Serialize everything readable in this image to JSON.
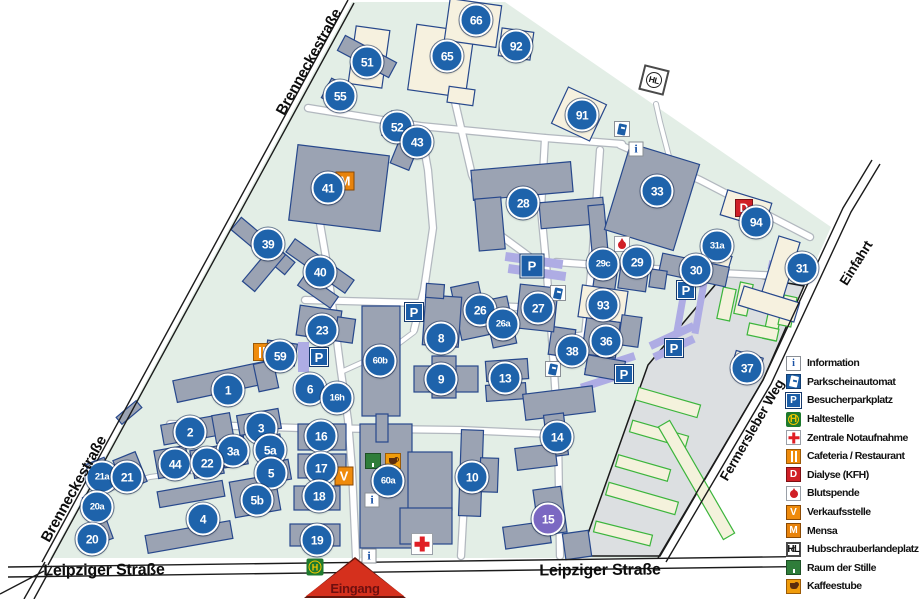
{
  "streets": {
    "brennecke": "Brenneckestraße",
    "leipziger": "Leipziger Straße",
    "fermersleber": "Fermersleber Weg",
    "einfahrt": "Einfahrt"
  },
  "entrance": {
    "label": "Eingang"
  },
  "colors": {
    "badge_blue": "#1e63ab",
    "badge_purple": "#7b68c2",
    "campus_green": "#e3eee6",
    "building_gray": "#9ba3b3",
    "building_cream": "#f6f1df",
    "parking_lavender": "#aeace4",
    "parking_blue": "#1b5ea7",
    "accent_orange": "#ef8b0c",
    "accent_red": "#d01f26",
    "accent_green": "#2f7d3a"
  },
  "badges": [
    {
      "label": "66",
      "x": 476,
      "y": 20
    },
    {
      "label": "92",
      "x": 516,
      "y": 46
    },
    {
      "label": "65",
      "x": 447,
      "y": 56
    },
    {
      "label": "51",
      "x": 367,
      "y": 62
    },
    {
      "label": "55",
      "x": 340,
      "y": 96
    },
    {
      "label": "52",
      "x": 397,
      "y": 127
    },
    {
      "label": "43",
      "x": 417,
      "y": 142
    },
    {
      "label": "91",
      "x": 582,
      "y": 115
    },
    {
      "label": "41",
      "x": 328,
      "y": 188
    },
    {
      "label": "28",
      "x": 523,
      "y": 203
    },
    {
      "label": "33",
      "x": 657,
      "y": 191
    },
    {
      "label": "94",
      "x": 756,
      "y": 222
    },
    {
      "label": "31a",
      "x": 717,
      "y": 246
    },
    {
      "label": "31",
      "x": 802,
      "y": 268
    },
    {
      "label": "30",
      "x": 696,
      "y": 270
    },
    {
      "label": "29",
      "x": 637,
      "y": 262
    },
    {
      "label": "29c",
      "x": 603,
      "y": 264
    },
    {
      "label": "93",
      "x": 603,
      "y": 305
    },
    {
      "label": "36",
      "x": 606,
      "y": 341
    },
    {
      "label": "38",
      "x": 572,
      "y": 351
    },
    {
      "label": "37",
      "x": 747,
      "y": 368
    },
    {
      "label": "27",
      "x": 538,
      "y": 308
    },
    {
      "label": "26",
      "x": 480,
      "y": 310
    },
    {
      "label": "26a",
      "x": 503,
      "y": 324
    },
    {
      "label": "39",
      "x": 268,
      "y": 244
    },
    {
      "label": "40",
      "x": 320,
      "y": 272
    },
    {
      "label": "23",
      "x": 322,
      "y": 330
    },
    {
      "label": "59",
      "x": 280,
      "y": 356
    },
    {
      "label": "6",
      "x": 310,
      "y": 389
    },
    {
      "label": "16h",
      "x": 337,
      "y": 398
    },
    {
      "label": "60b",
      "x": 380,
      "y": 361
    },
    {
      "label": "8",
      "x": 441,
      "y": 338
    },
    {
      "label": "9",
      "x": 441,
      "y": 379
    },
    {
      "label": "13",
      "x": 505,
      "y": 378
    },
    {
      "label": "1",
      "x": 228,
      "y": 390
    },
    {
      "label": "2",
      "x": 190,
      "y": 432
    },
    {
      "label": "3",
      "x": 261,
      "y": 428
    },
    {
      "label": "3a",
      "x": 233,
      "y": 451
    },
    {
      "label": "5a",
      "x": 270,
      "y": 450
    },
    {
      "label": "5",
      "x": 271,
      "y": 473
    },
    {
      "label": "5b",
      "x": 257,
      "y": 500
    },
    {
      "label": "44",
      "x": 175,
      "y": 464
    },
    {
      "label": "22",
      "x": 207,
      "y": 463
    },
    {
      "label": "21a",
      "x": 102,
      "y": 477
    },
    {
      "label": "21",
      "x": 127,
      "y": 477
    },
    {
      "label": "20a",
      "x": 97,
      "y": 507
    },
    {
      "label": "20",
      "x": 92,
      "y": 539
    },
    {
      "label": "4",
      "x": 203,
      "y": 519
    },
    {
      "label": "16",
      "x": 321,
      "y": 436
    },
    {
      "label": "17",
      "x": 321,
      "y": 468
    },
    {
      "label": "18",
      "x": 319,
      "y": 496
    },
    {
      "label": "19",
      "x": 317,
      "y": 540
    },
    {
      "label": "60a",
      "x": 388,
      "y": 481
    },
    {
      "label": "10",
      "x": 472,
      "y": 477
    },
    {
      "label": "14",
      "x": 557,
      "y": 437
    },
    {
      "label": "15",
      "x": 548,
      "y": 519,
      "variant": "purple"
    }
  ],
  "map_icons": [
    {
      "type": "mensa",
      "x": 345,
      "y": 181
    },
    {
      "type": "cafeteria",
      "x": 262,
      "y": 352
    },
    {
      "type": "verkauf",
      "x": 344,
      "y": 476
    },
    {
      "type": "kaffee",
      "x": 393,
      "y": 461
    },
    {
      "type": "stille",
      "x": 373,
      "y": 461
    },
    {
      "type": "dialyse",
      "x": 744,
      "y": 208
    },
    {
      "type": "blutspende",
      "x": 622,
      "y": 244
    },
    {
      "type": "notaufnahme",
      "x": 422,
      "y": 544
    },
    {
      "type": "information",
      "x": 636,
      "y": 149
    },
    {
      "type": "information",
      "x": 372,
      "y": 500
    },
    {
      "type": "information",
      "x": 369,
      "y": 556
    },
    {
      "type": "parkautomat",
      "x": 622,
      "y": 129
    },
    {
      "type": "parkautomat",
      "x": 558,
      "y": 293
    },
    {
      "type": "parkautomat",
      "x": 553,
      "y": 369
    },
    {
      "type": "parkplatz",
      "x": 532,
      "y": 266,
      "size": 23
    },
    {
      "type": "parkplatz",
      "x": 414,
      "y": 312
    },
    {
      "type": "parkplatz",
      "x": 319,
      "y": 357
    },
    {
      "type": "parkplatz",
      "x": 686,
      "y": 290
    },
    {
      "type": "parkplatz",
      "x": 674,
      "y": 348
    },
    {
      "type": "parkplatz",
      "x": 624,
      "y": 374
    },
    {
      "type": "haltestelle",
      "x": 315,
      "y": 567
    },
    {
      "type": "hubschrauber",
      "x": 654,
      "y": 80
    }
  ],
  "legend": {
    "items": [
      {
        "type": "information",
        "label": "Information"
      },
      {
        "type": "parkautomat",
        "label": "Parkscheinautomat"
      },
      {
        "type": "parkplatz",
        "label": "Besucherparkplatz"
      },
      {
        "type": "haltestelle",
        "label": "Haltestelle"
      },
      {
        "type": "notaufnahme",
        "label": "Zentrale Notaufnahme"
      },
      {
        "type": "cafeteria",
        "label": "Cafeteria / Restaurant"
      },
      {
        "type": "dialyse",
        "label": "Dialyse (KFH)"
      },
      {
        "type": "blutspende",
        "label": "Blutspende"
      },
      {
        "type": "verkauf",
        "label": "Verkaufsstelle"
      },
      {
        "type": "mensa",
        "label": "Mensa"
      },
      {
        "type": "hubschrauber",
        "label": "Hubschrauberlandeplatz"
      },
      {
        "type": "stille",
        "label": "Raum der Stille"
      },
      {
        "type": "kaffee",
        "label": "Kaffeestube"
      }
    ]
  }
}
